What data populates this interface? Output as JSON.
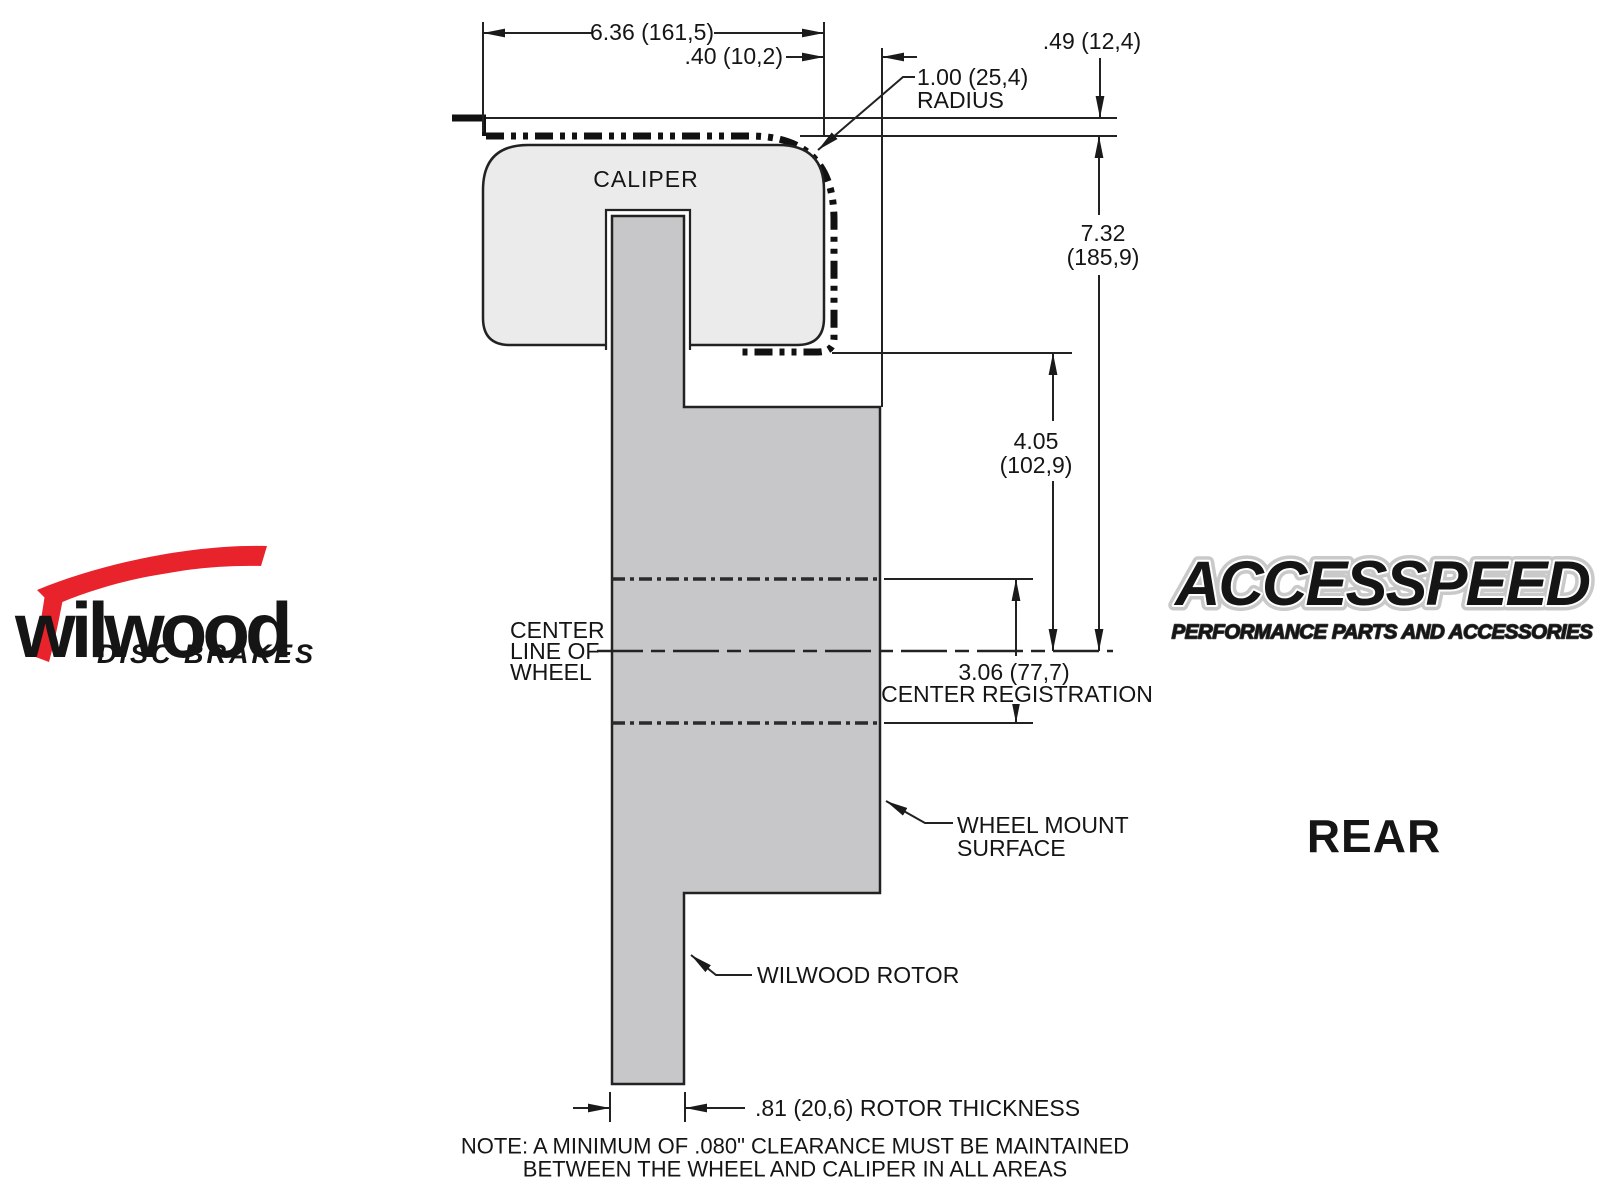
{
  "colors": {
    "caliper_fill": "#ebebeb",
    "rotor_fill": "#c7c7c9",
    "line": "#1f1f1f",
    "wilwood_red": "#e8232b"
  },
  "drawing": {
    "caliper_label": "CALIPER",
    "dim_width": "6.36 (161,5)",
    "dim_offset": ".40 (10,2)",
    "radius_line1": "1.00 (25,4)",
    "radius_line2": "RADIUS",
    "dim_lip": ".49 (12,4)",
    "dim_height_line1": "7.32",
    "dim_height_line2": "(185,9)",
    "dim_depth_line1": "4.05",
    "dim_depth_line2": "(102,9)",
    "dim_registration_line1": "3.06 (77,7)",
    "dim_registration_line2": "CENTER REGISTRATION",
    "centerline_line1": "CENTER",
    "centerline_line2": "LINE OF",
    "centerline_line3": "WHEEL",
    "wheel_mount_line1": "WHEEL MOUNT",
    "wheel_mount_line2": "SURFACE",
    "rotor_label": "WILWOOD ROTOR",
    "dim_rotor_thickness": ".81 (20,6) ROTOR THICKNESS",
    "note_line1": "NOTE: A MINIMUM OF .080\" CLEARANCE MUST BE MAINTAINED",
    "note_line2": "BETWEEN THE WHEEL AND CALIPER IN ALL AREAS",
    "view_label": "REAR"
  },
  "logos": {
    "wilwood_name": "wilwood",
    "wilwood_tagline": "DISC BRAKES",
    "accesspeed_name": "ACCESSPEED",
    "accesspeed_tagline": "PERFORMANCE PARTS AND ACCESSORIES"
  }
}
